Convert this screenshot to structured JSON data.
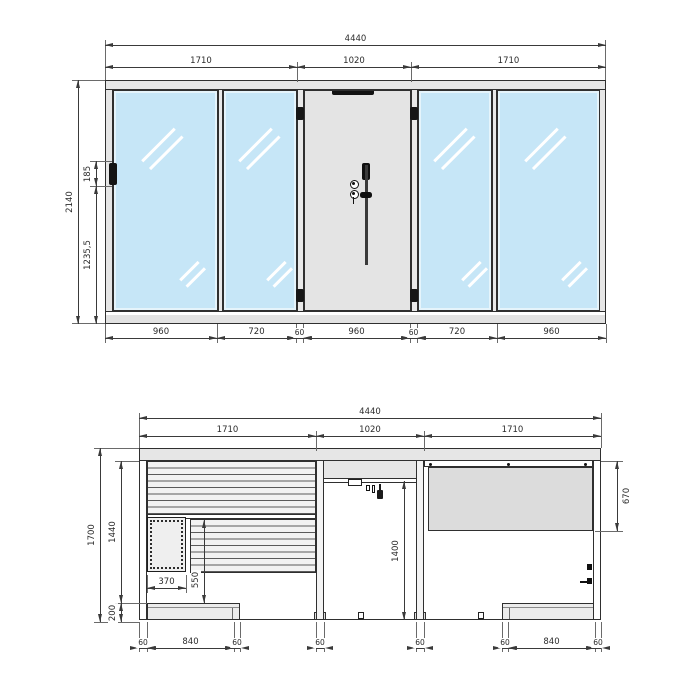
{
  "drawing": {
    "type": "sauna-shower-cabin-technical-drawing",
    "colors": {
      "glass_blue": "#c6e6f7",
      "frame_grey": "#e6e6e6",
      "panel_grey": "#dcdcdc",
      "line": "#2f2f2f"
    },
    "front_elevation": {
      "dim_overall_width": "4440",
      "dim_sections": [
        "1710",
        "1020",
        "1710"
      ],
      "dim_overall_height": "2140",
      "dim_hinge_zone": "185",
      "dim_hinge_to_floor": "1235,5",
      "dim_bottom": [
        "960",
        "720",
        "60",
        "960",
        "60",
        "720",
        "960"
      ]
    },
    "section_view": {
      "dim_overall_width": "4440",
      "dim_sections": [
        "1710",
        "1020",
        "1710"
      ],
      "dim_total_height": "1700",
      "dim_inner_height": "1440",
      "dim_bench_height": "200",
      "dim_door_height": "1400",
      "dim_glass_height": "670",
      "dim_heater_width": "370",
      "dim_heater_zone_height": "550",
      "dim_bottom_left": [
        "60",
        "840",
        "60"
      ],
      "dim_post_left": "60",
      "dim_post_right": "60",
      "dim_bottom_right": [
        "60",
        "840",
        "60"
      ]
    }
  }
}
